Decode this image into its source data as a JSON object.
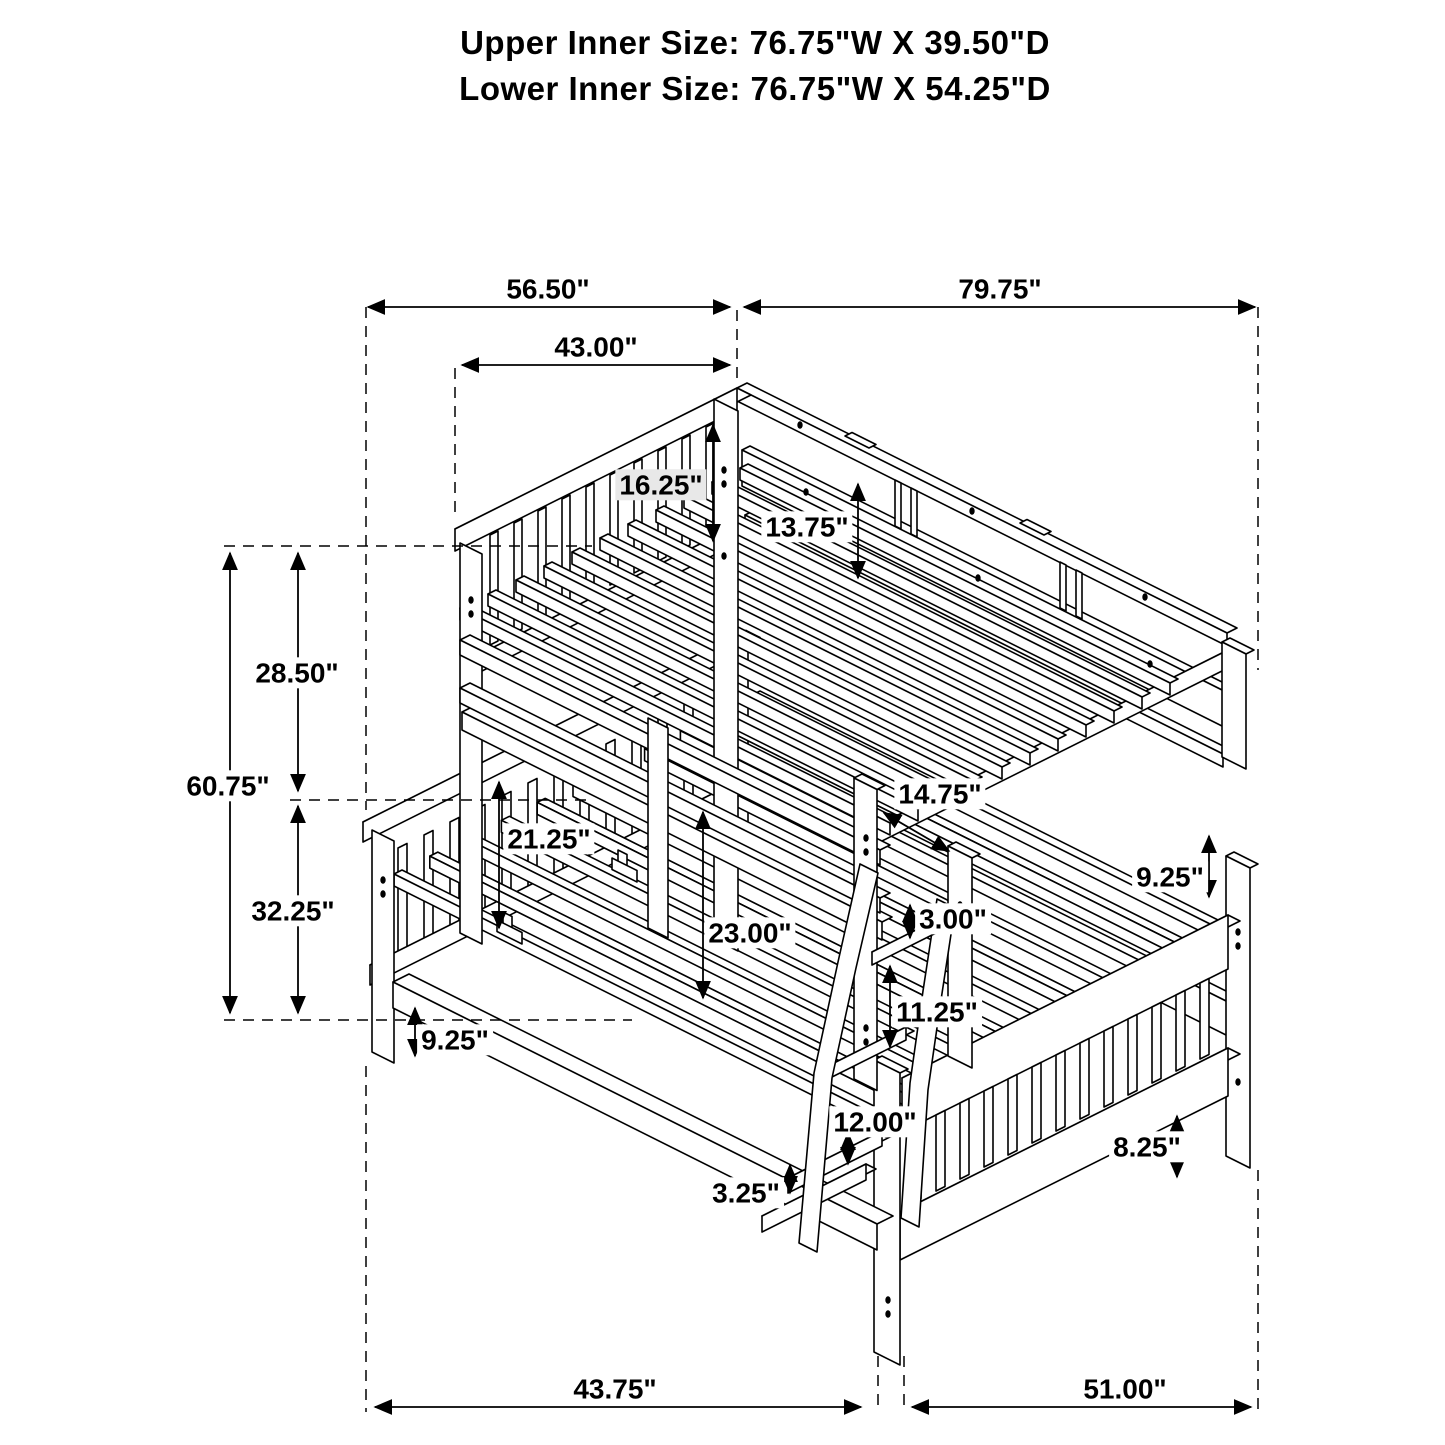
{
  "page": {
    "background": "#ffffff",
    "line_color": "#000000",
    "label_highlight": "#e8e8e8"
  },
  "title": {
    "upper": "Upper Inner Size: 76.75\"W X 39.50\"D",
    "lower": "Lower Inner Size: 76.75\"W X 54.25\"D"
  },
  "dimensions": {
    "top_left_span": "56.50\"",
    "top_right_span": "79.75\"",
    "upper_headboard_width": "43.00\"",
    "upper_section_height": "28.50\"",
    "overall_height": "60.75\"",
    "lower_section_height": "32.25\"",
    "upper_headboard_rail_height": "16.25\"",
    "upper_side_rail_height": "13.75\"",
    "lower_headboard_above_deck": "21.25\"",
    "bunk_gap_diagonal": "14.75\"",
    "deck_to_deck_height": "23.00\"",
    "ladder_first_step_offset": "3.00\"",
    "lower_side_rail_height": "9.25\"",
    "ladder_step_spacing": "11.25\"",
    "lower_deck_height": "9.25\"",
    "ladder_lower_step_spacing": "12.00\"",
    "ladder_foot_height": "3.25\"",
    "footboard_bottom_rail_height": "8.25\"",
    "bottom_left_span": "43.75\"",
    "bottom_right_span": "51.00\""
  }
}
